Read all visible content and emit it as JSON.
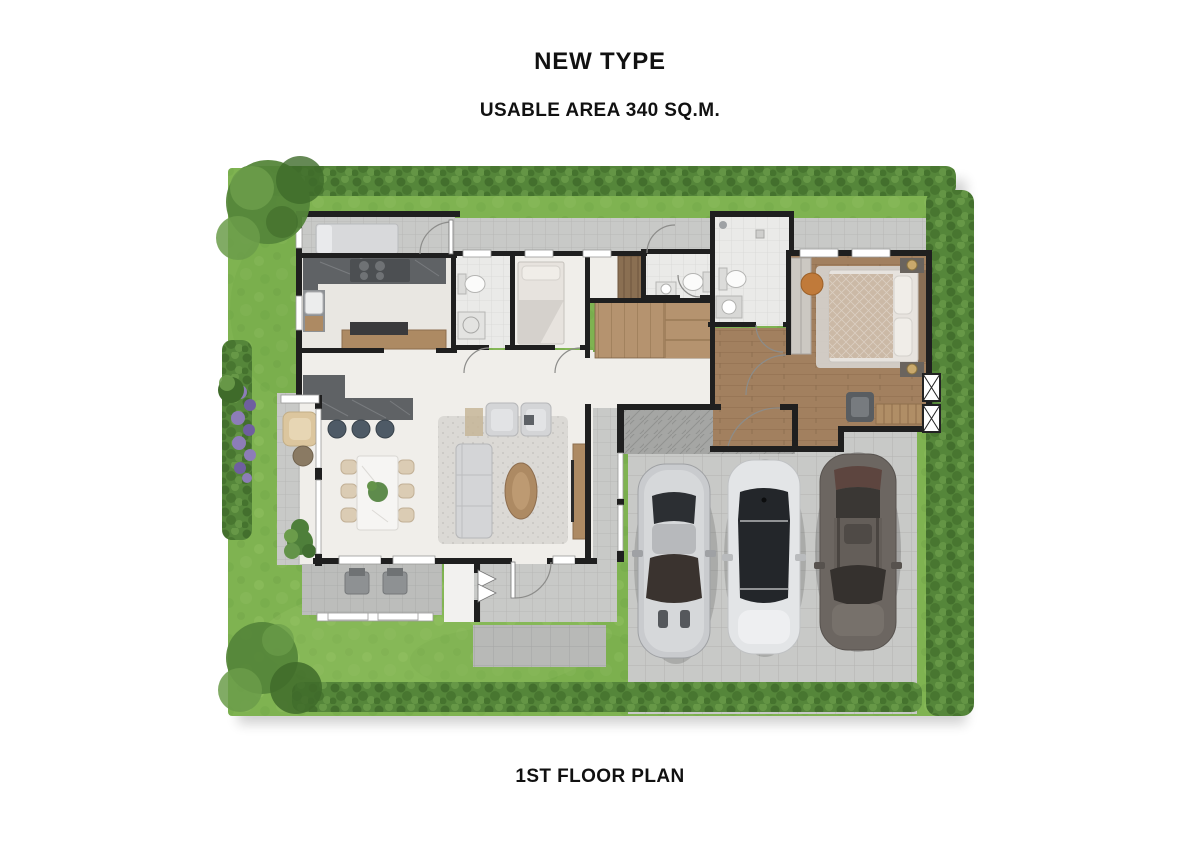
{
  "header": {
    "title": "NEW TYPE",
    "subtitle": "USABLE AREA 340 SQ.M."
  },
  "footer": {
    "caption": "1ST FLOOR PLAN"
  },
  "colors": {
    "text": "#111111",
    "wall": "#1f1f1f",
    "grass": "#7fb351",
    "grassLight": "#97c468",
    "grassDark": "#699e41",
    "hedge": "#55863a",
    "hedgeDark": "#3f6b2a",
    "hedgeLight": "#6b9c4a",
    "pave": "#c8c9c7",
    "paveLine": "#b3b4b2",
    "porch": "#a5a6a4",
    "porchLine": "#919290",
    "cream": "#f0eeea",
    "cream2": "#e9e7e2",
    "bathTile": "#eaeae8",
    "bathLine": "#d8d8d6",
    "wood": "#a2805f",
    "woodLine": "#8d6d4e",
    "stairWood": "#b5936f",
    "stairLine": "#9a7a57",
    "counter": "#5f6265",
    "counterVein": "#84878a",
    "sofa": "#d4d5d7",
    "rug": "#dbd9d5",
    "tableWood": "#ad8a63",
    "diningTable": "#f6f5f3",
    "chair": "#dbccb4",
    "terraceChair": "#dcc69e",
    "plant": "#4e7f3a",
    "flower": "#8d7db8",
    "flowerDark": "#6f5fa0",
    "bed": "#e7e3de",
    "duvet": "#cbb9a6",
    "pillow": "#f0ede8",
    "wardrobe": "#8a6f52",
    "carSilver": "#c9cbce",
    "carWhite": "#e3e5e7",
    "carDark": "#6c6661",
    "glass": "#2c2f33"
  }
}
